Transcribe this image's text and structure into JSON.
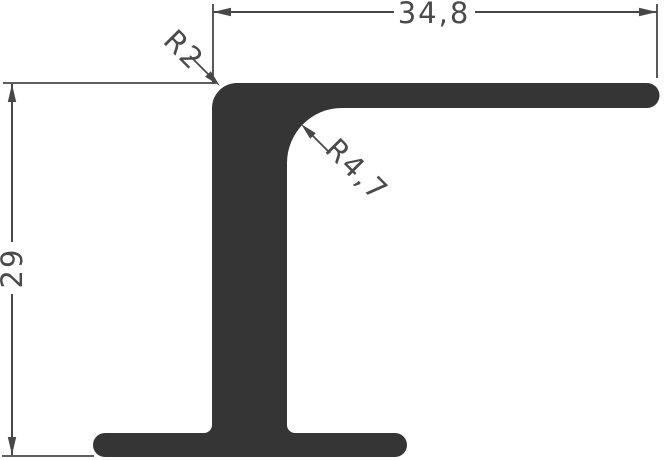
{
  "colors": {
    "background": "#ffffff",
    "profile": "#353535",
    "line": "#474747",
    "text": "#4a4a4a"
  },
  "drawing": {
    "dimensions": {
      "width": "34,8",
      "height": "29",
      "outer_corner_radius": "R2",
      "inner_fillet_radius": "R4,7"
    }
  }
}
